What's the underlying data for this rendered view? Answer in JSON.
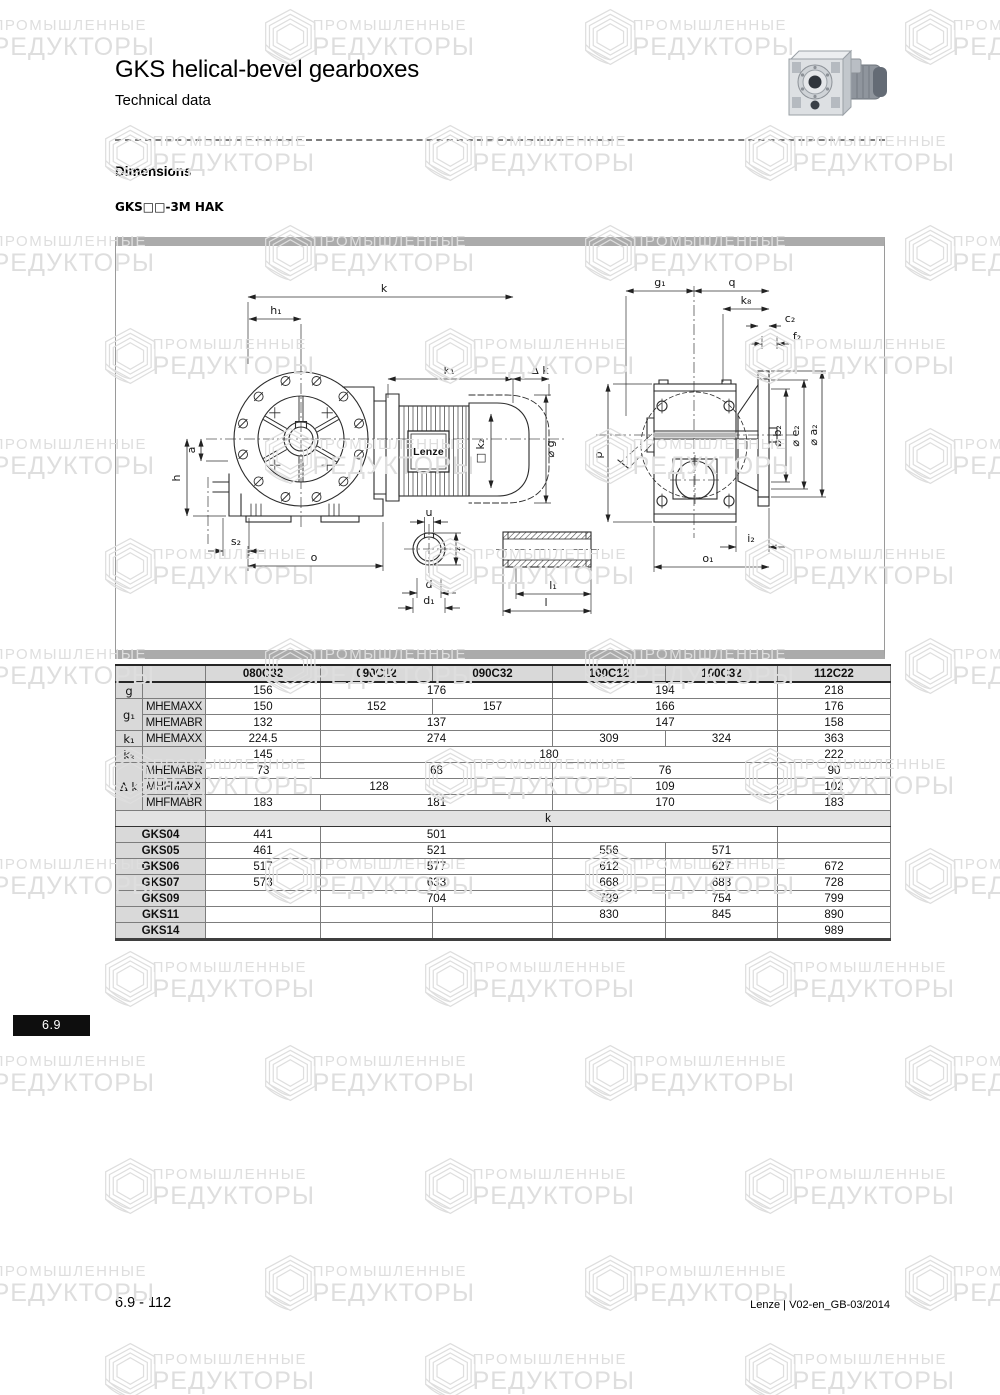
{
  "header": {
    "title": "GKS helical-bevel gearboxes",
    "subtitle": "Technical data"
  },
  "section": {
    "heading": "Dimensions",
    "variant_label": "GKS□□-3M HAK"
  },
  "drawing": {
    "labels": {
      "k": "k",
      "h1": "h₁",
      "k1": "k₁",
      "dk": "Δ k",
      "g_dia": "⌀ g",
      "k2sq": "□ k₂",
      "lenze": "Lenze",
      "a": "a",
      "h": "h",
      "s2": "s₂",
      "o": "o",
      "u": "u",
      "f": "f",
      "d": "d",
      "d1": "d₁",
      "l1": "l₁",
      "l": "l",
      "g1": "g₁",
      "q": "q",
      "k8": "k₈",
      "c2": "c₂",
      "f2": "f₂",
      "b2": "⌀ b₂",
      "e2": "⌀ e₂",
      "a2": "⌀ a₂",
      "p": "p",
      "i2": "i₂",
      "o1": "o₁"
    }
  },
  "table": {
    "columns": [
      "080C32",
      "090C12",
      "090C32",
      "100C12",
      "100C32",
      "112C22"
    ],
    "rows": [
      {
        "rc": "r-hdr",
        "cells": [
          {
            "t": "",
            "c": "hdr"
          },
          {
            "t": "",
            "c": "hdr"
          },
          {
            "t": "080C32",
            "c": "hdr"
          },
          {
            "t": "090C12",
            "c": "hdr"
          },
          {
            "t": "090C32",
            "c": "hdr"
          },
          {
            "t": "100C12",
            "c": "hdr"
          },
          {
            "t": "100C32",
            "c": "hdr"
          },
          {
            "t": "112C22",
            "c": "hdr"
          }
        ]
      },
      {
        "cells": [
          {
            "t": "g",
            "c": "lab"
          },
          {
            "t": "",
            "c": "sub"
          },
          {
            "t": "156"
          },
          {
            "t": "176",
            "cs": 2
          },
          {
            "t": "194",
            "cs": 2
          },
          {
            "t": "218"
          }
        ]
      },
      {
        "cells": [
          {
            "t": "g₁",
            "c": "lab",
            "rs": 2
          },
          {
            "t": "MHEMAXX",
            "c": "sub"
          },
          {
            "t": "150"
          },
          {
            "t": "152"
          },
          {
            "t": "157"
          },
          {
            "t": "166",
            "cs": 2
          },
          {
            "t": "176"
          }
        ]
      },
      {
        "cells": [
          {
            "t": "MHEMABR",
            "c": "sub"
          },
          {
            "t": "132"
          },
          {
            "t": "137",
            "cs": 2
          },
          {
            "t": "147",
            "cs": 2
          },
          {
            "t": "158"
          }
        ]
      },
      {
        "cells": [
          {
            "t": "k₁",
            "c": "lab"
          },
          {
            "t": "MHEMAXX",
            "c": "sub"
          },
          {
            "t": "224.5"
          },
          {
            "t": "274",
            "cs": 2
          },
          {
            "t": "309"
          },
          {
            "t": "324"
          },
          {
            "t": "363"
          }
        ]
      },
      {
        "cells": [
          {
            "t": "k₂",
            "c": "lab"
          },
          {
            "t": "",
            "c": "sub"
          },
          {
            "t": "145"
          },
          {
            "t": "180",
            "cs": 4
          },
          {
            "t": "222"
          }
        ]
      },
      {
        "cells": [
          {
            "t": "Δ k",
            "c": "lab",
            "rs": 3
          },
          {
            "t": "MHEMABR",
            "c": "sub"
          },
          {
            "t": "73"
          },
          {
            "t": "68",
            "cs": 2
          },
          {
            "t": "76",
            "cs": 2
          },
          {
            "t": "90"
          }
        ]
      },
      {
        "cells": [
          {
            "t": "MHFMAXX",
            "c": "sub"
          },
          {
            "t": "128",
            "cs": 3
          },
          {
            "t": "109",
            "cs": 2
          },
          {
            "t": "102"
          }
        ]
      },
      {
        "cells": [
          {
            "t": "MHFMABR",
            "c": "sub"
          },
          {
            "t": "183"
          },
          {
            "t": "181",
            "cs": 2
          },
          {
            "t": "170",
            "cs": 2
          },
          {
            "t": "183"
          }
        ]
      },
      {
        "rc": "r-kband",
        "cells": [
          {
            "t": "",
            "c": "kb",
            "cs": 2
          },
          {
            "t": "k",
            "c": "kband",
            "cs": 6
          }
        ]
      },
      {
        "cells": [
          {
            "t": "GKS04",
            "c": "gks",
            "cs": 2
          },
          {
            "t": "441"
          },
          {
            "t": "501",
            "cs": 2
          },
          {
            "t": "",
            "cs": 2
          },
          {
            "t": ""
          }
        ]
      },
      {
        "cells": [
          {
            "t": "GKS05",
            "c": "gks",
            "cs": 2
          },
          {
            "t": "461"
          },
          {
            "t": "521",
            "cs": 2
          },
          {
            "t": "556"
          },
          {
            "t": "571"
          },
          {
            "t": ""
          }
        ]
      },
      {
        "cells": [
          {
            "t": "GKS06",
            "c": "gks",
            "cs": 2
          },
          {
            "t": "517"
          },
          {
            "t": "577",
            "cs": 2
          },
          {
            "t": "612"
          },
          {
            "t": "627"
          },
          {
            "t": "672"
          }
        ]
      },
      {
        "cells": [
          {
            "t": "GKS07",
            "c": "gks",
            "cs": 2
          },
          {
            "t": "573"
          },
          {
            "t": "633",
            "cs": 2
          },
          {
            "t": "668"
          },
          {
            "t": "683"
          },
          {
            "t": "728"
          }
        ]
      },
      {
        "cells": [
          {
            "t": "GKS09",
            "c": "gks",
            "cs": 2
          },
          {
            "t": ""
          },
          {
            "t": "704",
            "cs": 2
          },
          {
            "t": "739"
          },
          {
            "t": "754"
          },
          {
            "t": "799"
          }
        ]
      },
      {
        "cells": [
          {
            "t": "GKS11",
            "c": "gks",
            "cs": 2
          },
          {
            "t": ""
          },
          {
            "t": ""
          },
          {
            "t": ""
          },
          {
            "t": "830"
          },
          {
            "t": "845"
          },
          {
            "t": "890"
          }
        ]
      },
      {
        "cells": [
          {
            "t": "GKS14",
            "c": "gks",
            "cs": 2
          },
          {
            "t": ""
          },
          {
            "t": ""
          },
          {
            "t": ""
          },
          {
            "t": ""
          },
          {
            "t": ""
          },
          {
            "t": "989"
          }
        ]
      }
    ]
  },
  "badge": {
    "text": "6.9"
  },
  "footer": {
    "page_number": "6.9 - 112",
    "doc_info": "Lenze | V02-en_GB-03/2014"
  },
  "watermark": {
    "line1": "ПРОМЫШЛЕННЫЕ",
    "line2": "РЕДУКТОРЫ"
  }
}
